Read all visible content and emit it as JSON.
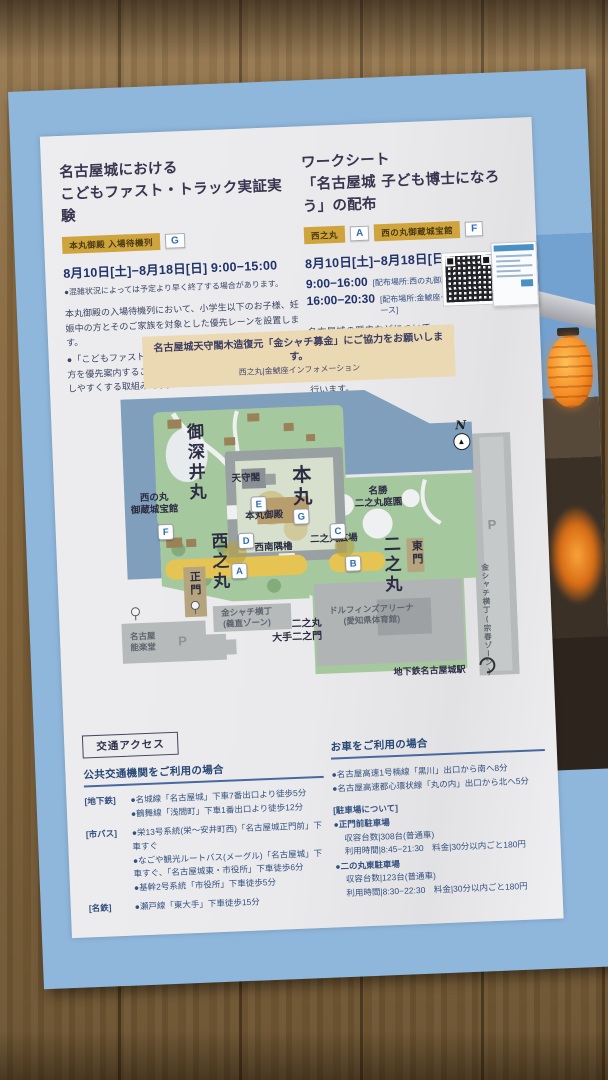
{
  "events": {
    "left": {
      "title_line1": "名古屋城における",
      "title_line2": "こどもファスト・トラック実証実験",
      "badge_label": "本丸御殿 入場待機列",
      "badge_letter": "G",
      "date": "8月10日[土]−8月18日[日] 9:00−15:00",
      "note": "●混雑状況によっては予定より早く終了する場合があります。",
      "body1": "本丸御殿の入場待機列において、小学生以下のお子様、妊娠中の方とそのご家族を対象とした優先レーンを設置します。",
      "body2": "●「こどもファスト・トラック」とは、子ども、妊娠中の方を優先案内することで、子育て世帯が様々な施設を利用しやすくする取組みです。"
    },
    "right": {
      "title_line1": "ワークシート",
      "title_line2": "「名古屋城 子ども博士になろう」の配布",
      "badge1_label": "西之丸",
      "badge1_letter": "A",
      "badge2_label": "西の丸御蔵城宝館",
      "badge2_letter": "F",
      "date": "8月10日[土]−8月18日[日]",
      "slots": [
        {
          "time": "9:00−16:00",
          "place": "[配布場所:西の丸御蔵城宝館]"
        },
        {
          "time": "16:00−20:30",
          "place": "[配布場所:金鯱座インフォメーションブース]"
        }
      ],
      "body": "名古屋城の歴史などについて、楽しく学べる子ども向けの書き込み式ワークシート「名古屋城 子ども博士になろう」の配布を行います。"
    }
  },
  "banner": {
    "main": "名古屋城天守閣木造復元「金シャチ募金」にご協力をお願いします。",
    "sub": "西之丸|金鯱座インフォメーション"
  },
  "map": {
    "labels": {
      "ofukemaru": "御深井丸",
      "tenshukaku": "天守閣",
      "honmaru": "本丸",
      "honmaru_goten": "本丸御殿",
      "seinan_sumiyagura": "西南隅櫓",
      "nishinomaru": "西之丸",
      "museum_l1": "西の丸",
      "museum_l2": "御蔵城宝館",
      "seimon": "正門",
      "meisho": "名勝",
      "teien": "二之丸庭園",
      "ninomaru_hiroba": "二之丸広場",
      "ninomaru": "二之丸",
      "higashimon": "東門",
      "otemon_l1": "二之丸",
      "otemon_l2": "大手二之門",
      "arena_l1": "ドルフィンズアリーナ",
      "arena_l2": "(愛知県体育館)",
      "yoshinao_l1": "金シャチ横丁",
      "yoshinao_l2": "(義直ゾーン)",
      "muneharu": "金シャチ横丁(宗春ゾーン)",
      "nohgakudo_l1": "名古屋",
      "nohgakudo_l2": "能楽堂",
      "subway_station": "地下鉄名古屋城駅",
      "north": "N",
      "north_arrow": "▲",
      "p_east": "P",
      "p_south": "P"
    },
    "markers": {
      "a": "A",
      "b": "B",
      "c": "C",
      "d": "D",
      "e": "E",
      "f": "F",
      "g": "G"
    }
  },
  "access": {
    "box_title": "交通アクセス",
    "public": {
      "heading": "公共交通機関をご利用の場合",
      "rows": [
        {
          "label": "[地下鉄]",
          "items": [
            "●名城線「名古屋城」下車7番出口より徒歩5分",
            "●鶴舞線「浅間町」下車1番出口より徒歩12分"
          ]
        },
        {
          "label": "[市バス]",
          "items": [
            "●栄13号系統(栄〜安井町西)「名古屋城正門前」下車すぐ",
            "●なごや観光ルートバス(メーグル)「名古屋城」下車すぐ、「名古屋城東・市役所」下車徒歩6分",
            "●基幹2号系統「市役所」下車徒歩5分"
          ]
        },
        {
          "label": "[名鉄]",
          "items": [
            "●瀬戸線「東大手」下車徒歩15分"
          ]
        }
      ]
    },
    "car": {
      "heading": "お車をご利用の場合",
      "bullets": [
        "●名古屋高速1号楠線「黒川」出口から南へ8分",
        "●名古屋高速都心環状線「丸の内」出口から北へ5分"
      ],
      "parking_title": "[駐車場について]",
      "lots": [
        {
          "name": "●正門前駐車場",
          "capacity": "収容台数|308台(普通車)",
          "hours": "利用時間|8:45−21:30　料金|30分以内ごと180円"
        },
        {
          "name": "●二の丸東駐車場",
          "capacity": "収容台数|123台(普通車)",
          "hours": "利用時間|8:30−22:30　料金|30分以内ごと180円"
        }
      ]
    }
  },
  "colors": {
    "page_blue": "#8fb7dc",
    "badge_gold": "#cfa43d",
    "marker_blue": "#2f6cb5",
    "banner_beige": "#ead9b2",
    "map_green": "#a6c89f",
    "map_moat": "#7f9fbc",
    "map_gray": "#b7babb",
    "lane_yellow": "#e5c453"
  }
}
